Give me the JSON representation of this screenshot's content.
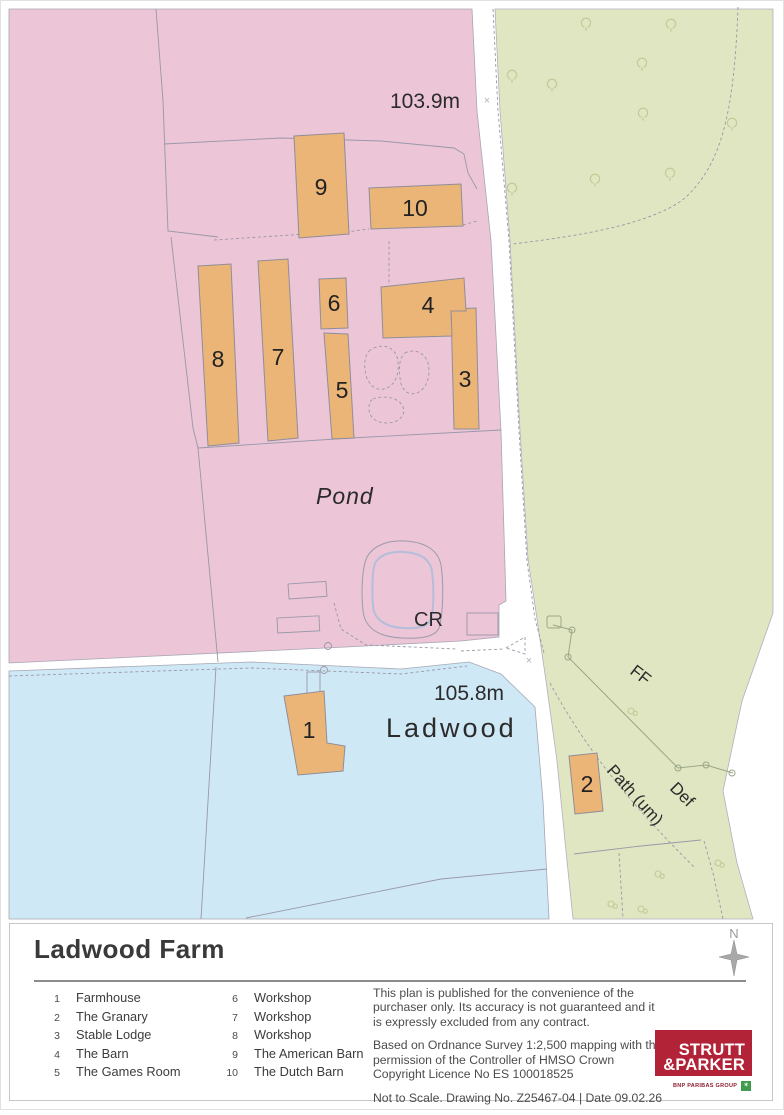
{
  "map": {
    "labels": {
      "spot_height_north": "103.9m",
      "spot_height_south": "105.8m",
      "pond": "Pond",
      "cr": "CR",
      "place": "Ladwood",
      "ff": "FF",
      "path_um": "Path (um)",
      "def": "Def"
    },
    "cross_mark": "×",
    "buildings": [
      {
        "number": "1"
      },
      {
        "number": "2"
      },
      {
        "number": "3"
      },
      {
        "number": "4"
      },
      {
        "number": "5"
      },
      {
        "number": "6"
      },
      {
        "number": "7"
      },
      {
        "number": "8"
      },
      {
        "number": "9"
      },
      {
        "number": "10"
      }
    ]
  },
  "footer": {
    "title": "Ladwood Farm",
    "north_label": "N",
    "legend": [
      {
        "number": "1",
        "name": "Farmhouse"
      },
      {
        "number": "2",
        "name": "The Granary"
      },
      {
        "number": "3",
        "name": "Stable Lodge"
      },
      {
        "number": "4",
        "name": "The Barn"
      },
      {
        "number": "5",
        "name": "The Games Room"
      },
      {
        "number": "6",
        "name": "Workshop"
      },
      {
        "number": "7",
        "name": "Workshop"
      },
      {
        "number": "8",
        "name": "Workshop"
      },
      {
        "number": "9",
        "name": "The American Barn"
      },
      {
        "number": "10",
        "name": "The Dutch Barn"
      }
    ],
    "disclaimer": "This plan is published for the convenience of the purchaser only. Its accuracy is not guaranteed and it is expressly excluded from any contract.",
    "attribution": "Based on Ordnance Survey 1:2,500 mapping with the permission of the Controller of HMSO  Crown Copyright Licence No ES 100018525",
    "scale_note": "Not to Scale. Drawing No. Z25467-04 | Date 09.02.26",
    "logo": {
      "line1": "STRUTT",
      "line2": "&PARKER",
      "subtext": "BNP PARIBAS GROUP",
      "mark": "✶"
    }
  },
  "colors": {
    "parcel_pink": "#ecc5d7",
    "parcel_green": "#e1e6c2",
    "parcel_blue": "#cfe8f6",
    "building_fill": "#ecb578",
    "pond_water": "#b4bedb",
    "logo_red": "#b22338",
    "bnp_green": "#3f9c4e"
  }
}
